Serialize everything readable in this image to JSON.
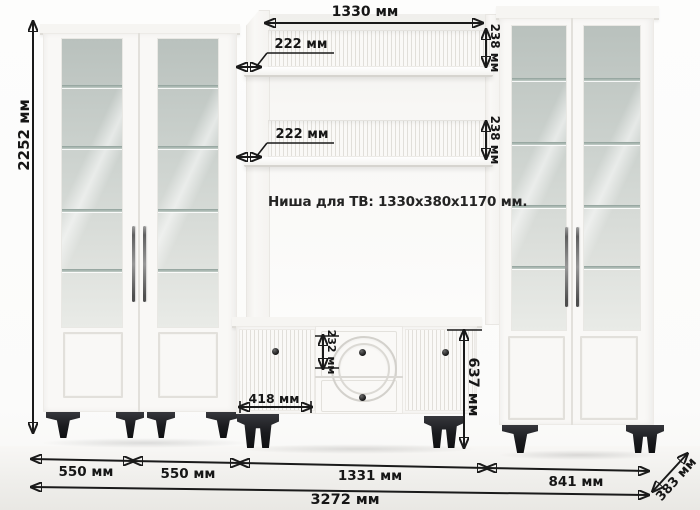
{
  "diagram": {
    "niche_note": "Ниша для ТВ: 1330x380x1170 мм.",
    "dims": {
      "total_height": "2252 мм",
      "niche_width": "1330 мм",
      "shelf_top_depth": "222 мм",
      "shelf_bottom_depth": "222 мм",
      "shelf_top_height": "238 мм",
      "shelf_bottom_height": "238 мм",
      "drawer_height": "232 мм",
      "stand_door_width": "418 мм",
      "stand_height": "637 мм",
      "left_cabinet_1_width": "550 мм",
      "left_cabinet_2_width": "550 мм",
      "stand_section_width": "1331 мм",
      "right_cabinets_width": "841 мм",
      "total_width": "3272 мм",
      "depth": "383 мм"
    },
    "colors": {
      "dimension_ink": "#1a1a1a",
      "furniture_white": "#f9f8f6",
      "glass_tint": "#ccd2ce",
      "leg_black": "#1a1b1e"
    }
  }
}
